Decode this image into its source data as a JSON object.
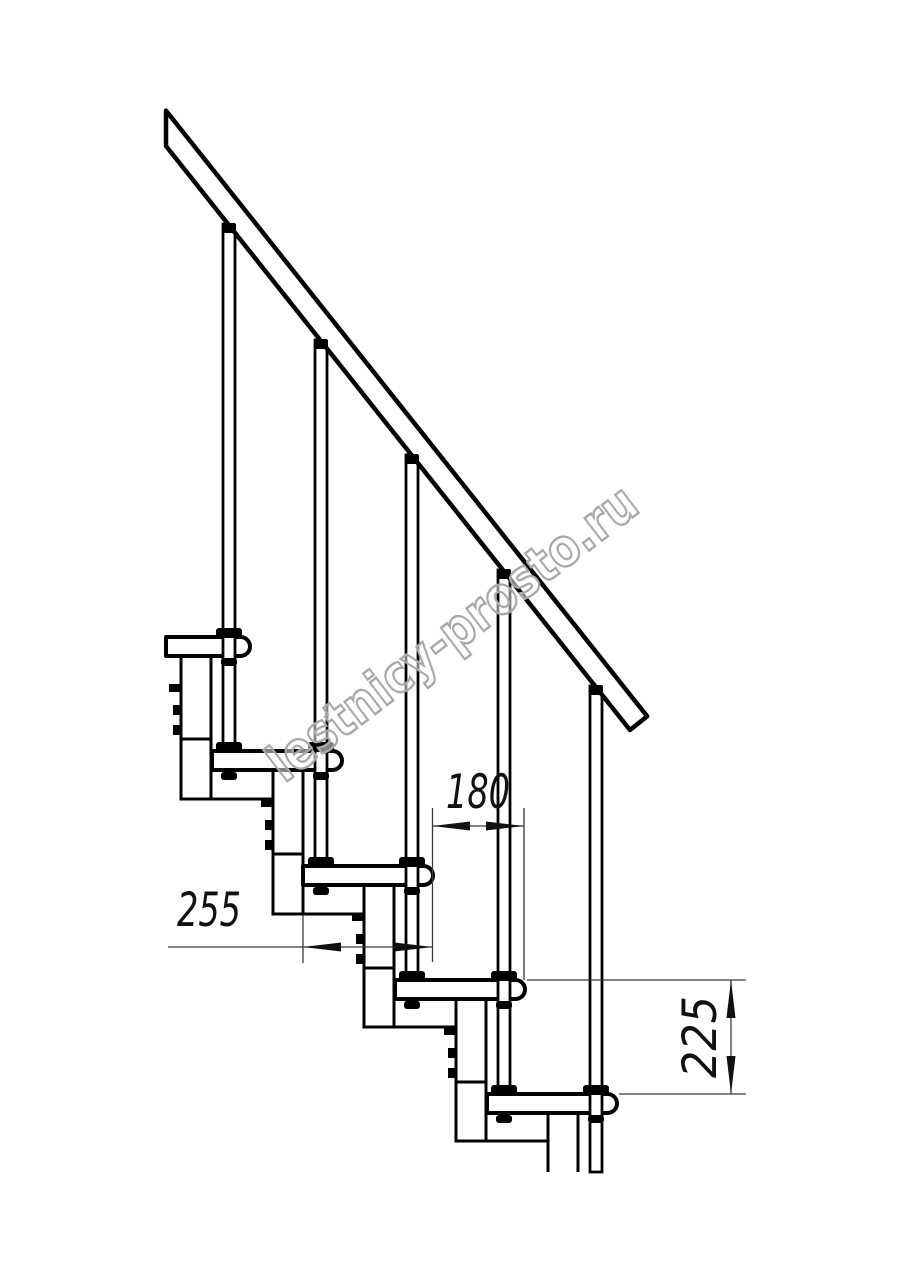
{
  "drawing": {
    "title": "staircase-side-view",
    "watermark": {
      "text": "lestnicy-prosto.ru"
    },
    "dimensions": {
      "step_run": "180",
      "tread_depth": "255",
      "step_rise": "225"
    },
    "colors": {
      "line": "#000000",
      "dim_line": "#3a3a3a",
      "watermark_stroke": "#a9a9a9",
      "background": "#ffffff"
    }
  }
}
